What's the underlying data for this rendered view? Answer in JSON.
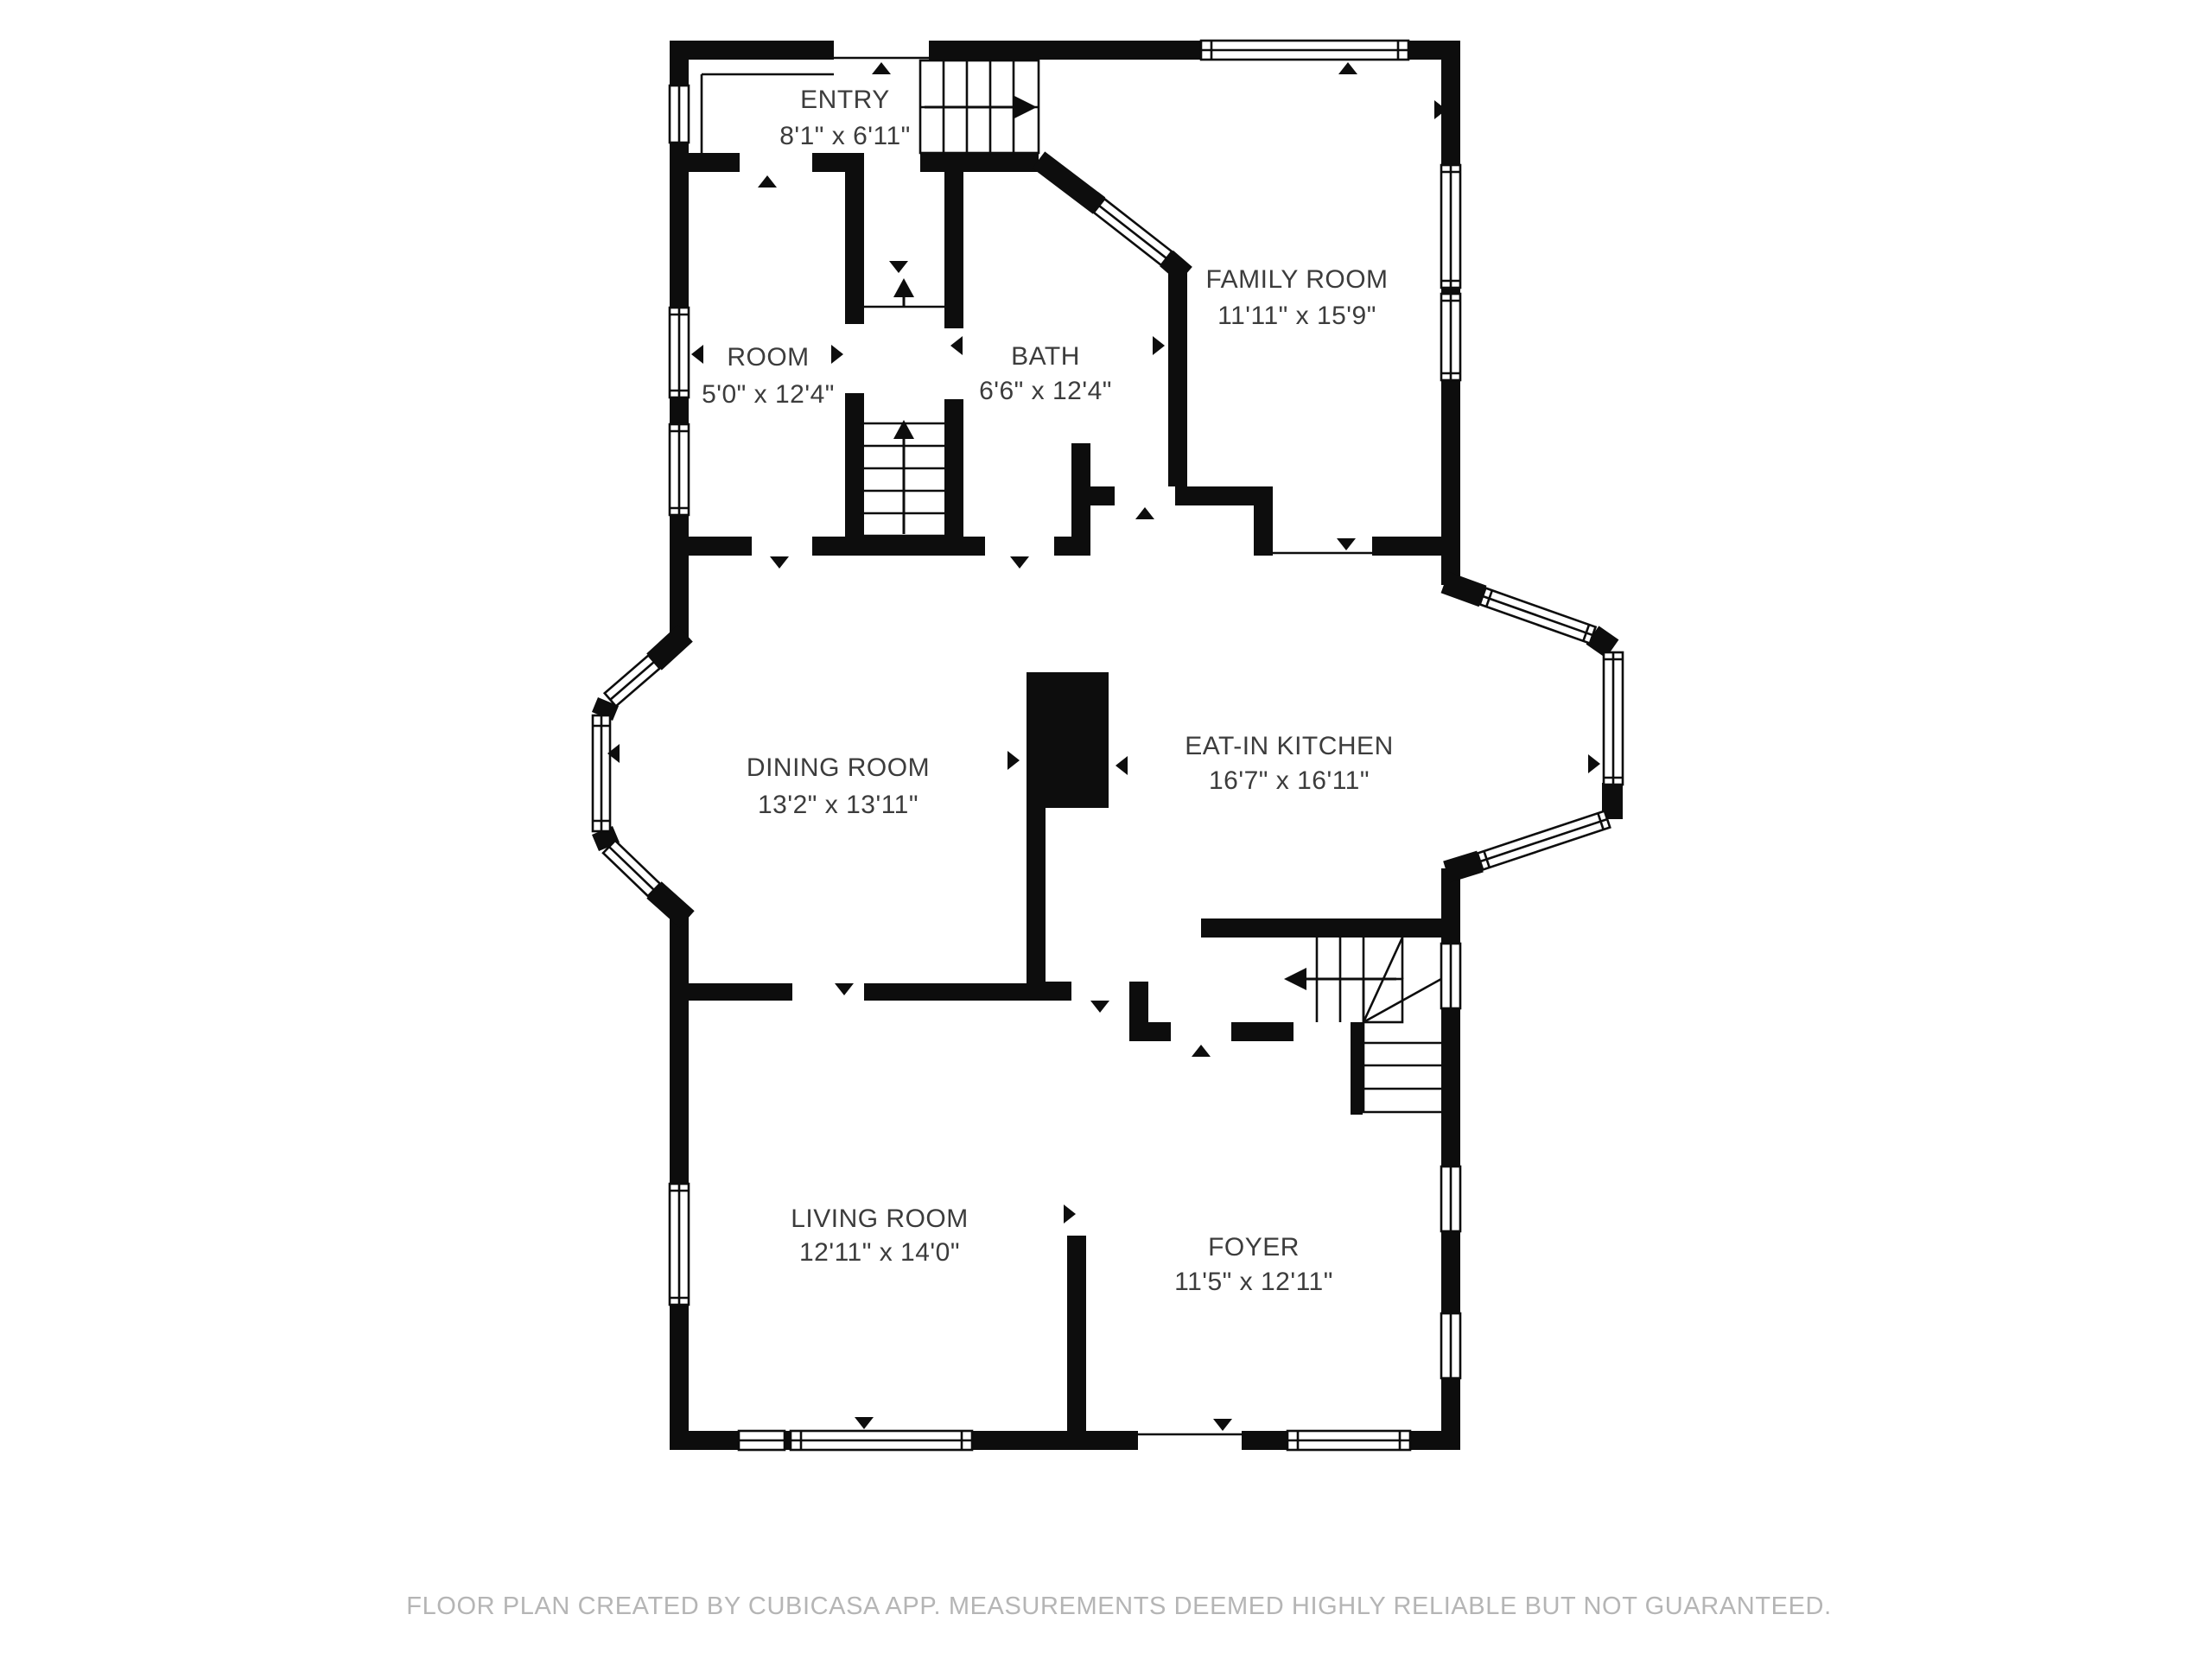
{
  "plan": {
    "rooms": [
      {
        "id": "entry",
        "name": "ENTRY",
        "dims": "8'1\" x 6'11\""
      },
      {
        "id": "room",
        "name": "ROOM",
        "dims": "5'0\" x 12'4\""
      },
      {
        "id": "bath",
        "name": "BATH",
        "dims": "6'6\" x 12'4\""
      },
      {
        "id": "family-room",
        "name": "FAMILY ROOM",
        "dims": "11'11\" x 15'9\""
      },
      {
        "id": "dining-room",
        "name": "DINING ROOM",
        "dims": "13'2\" x 13'11\""
      },
      {
        "id": "eat-in-kitchen",
        "name": "EAT-IN KITCHEN",
        "dims": "16'7\" x 16'11\""
      },
      {
        "id": "living-room",
        "name": "LIVING ROOM",
        "dims": "12'11\" x 14'0\""
      },
      {
        "id": "foyer",
        "name": "FOYER",
        "dims": "11'5\" x 12'11\""
      }
    ],
    "colors": {
      "wall": "#0d0d0d",
      "label": "#3c3c3c",
      "footer_text": "#b5b5b5",
      "background": "#ffffff"
    }
  },
  "footer": {
    "disclaimer": "FLOOR PLAN CREATED BY CUBICASA APP. MEASUREMENTS DEEMED HIGHLY RELIABLE BUT NOT GUARANTEED."
  }
}
